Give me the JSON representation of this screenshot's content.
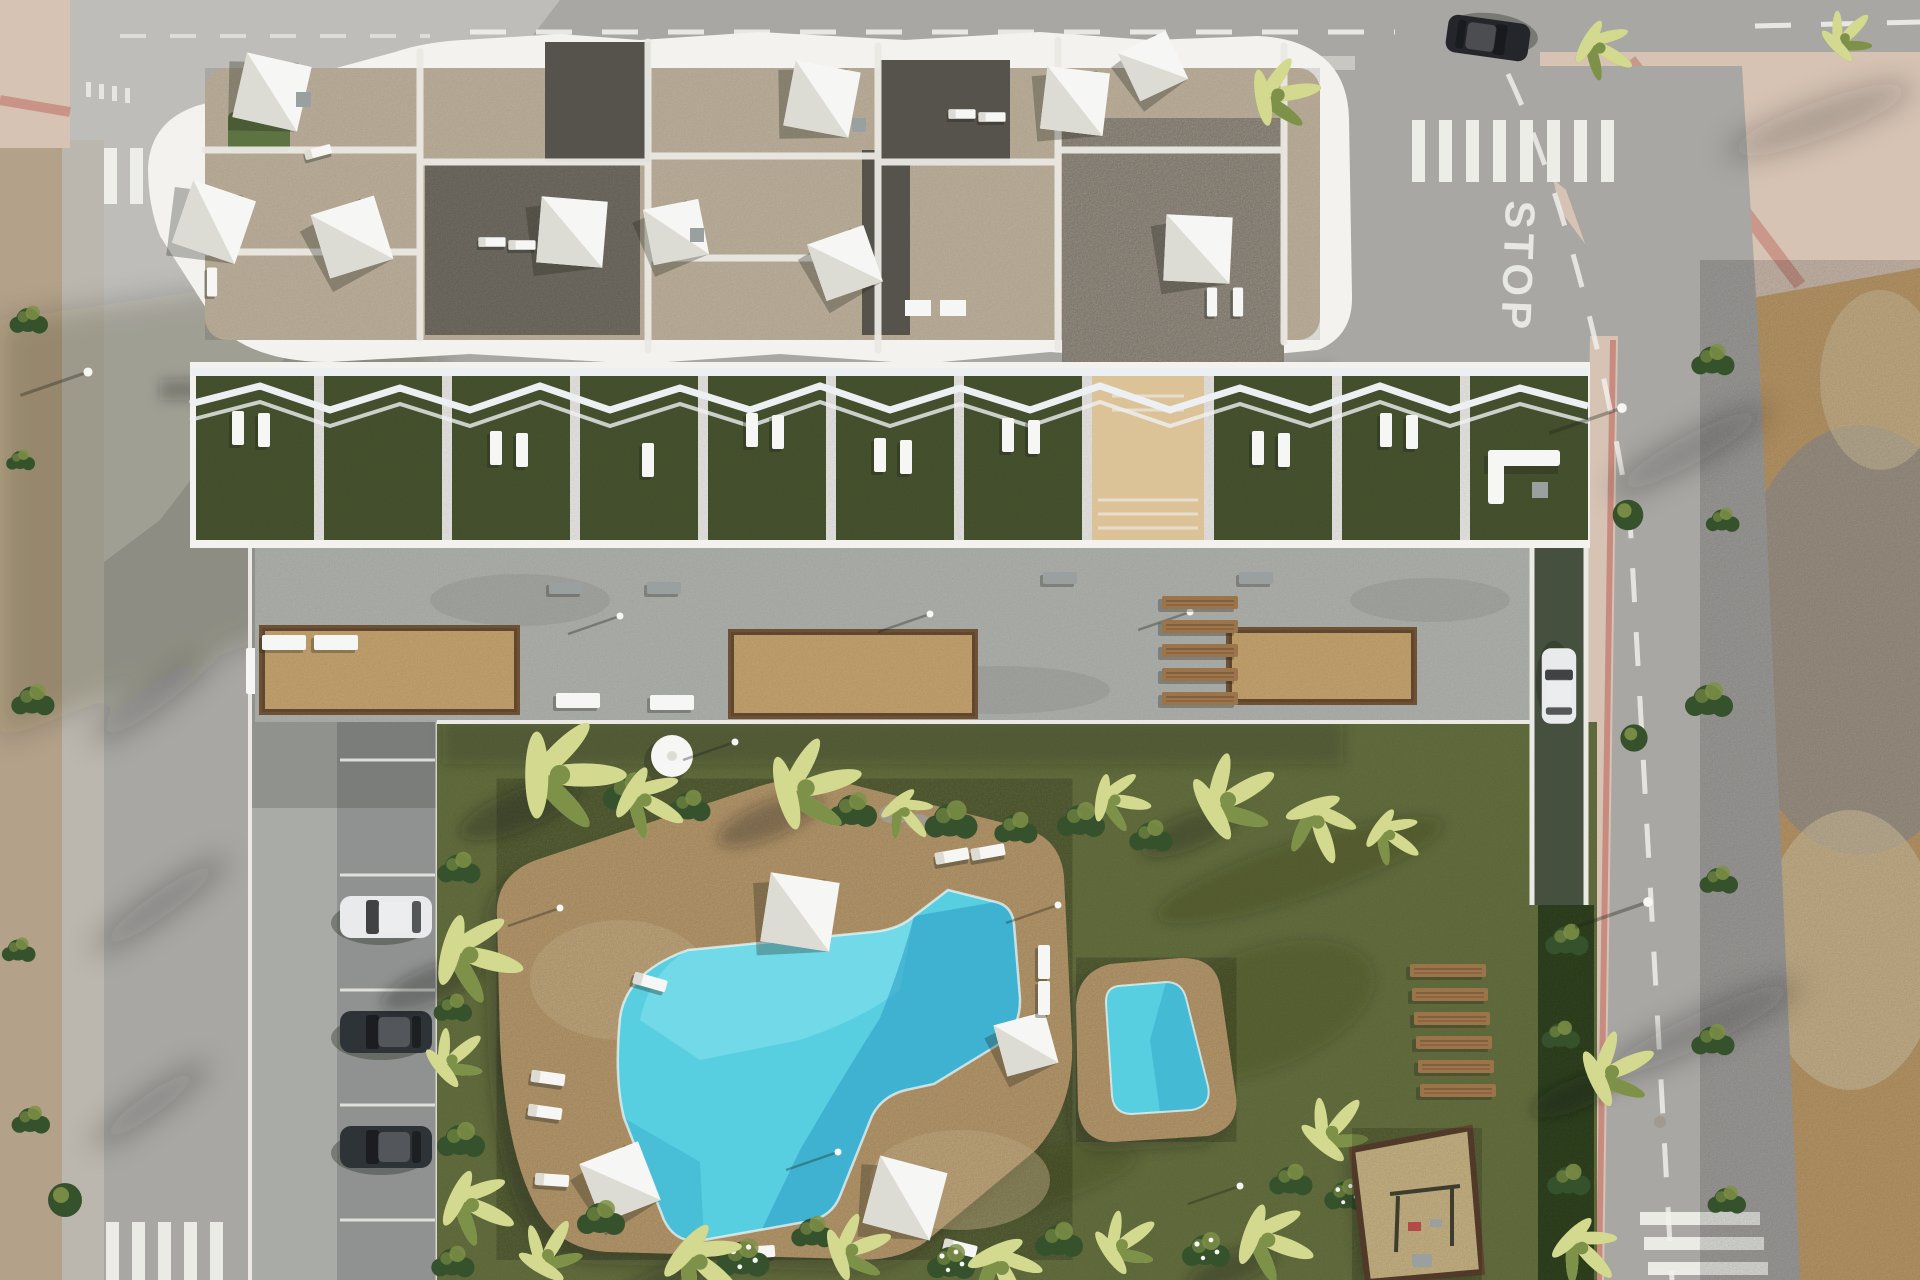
{
  "meta": {
    "description": "Top-down aerial 3D architectural render of a modern white apartment complex with rooftop terraces and shade sails, a row of private grass garden terraces, a communal concrete plaza with sand planters, a large lawned garden with palm trees, a free-form turquoise swimming pool with sun deck, a separate kids pool, wooden sun decks, a playground with swings, street parking and surrounding roads with an empty dirt lot",
    "view": "aerial top-down"
  },
  "roads": {
    "stop_marking": "STOP"
  },
  "colors": {
    "road": "#a8a7a4",
    "roadLight": "#d6d4cf",
    "laneWhite": "#f3f3ee",
    "sidewalkLeft": "#bcb7ae",
    "dirtLeft": "#b3a189",
    "dirtLight": "#d9c7a2",
    "concreteWalk": "#a9aba7",
    "parkingAsphalt": "#8f9290",
    "kerb": "#ebe9e4",
    "plaza": "#b9bbb6",
    "planterSand": "#d4b077",
    "planterEdge": "#6e5134",
    "building": "#f3f2ef",
    "roofStone": "#c9bca6",
    "gravelLight": "#b3a99b",
    "gravelDark": "#857f74",
    "roofDark": "#56534d",
    "roofGreen": "#5d7342",
    "pergola": "#edf0f2",
    "terraceGrass": "#4c5832",
    "lawn": "#6d7944",
    "shrub": "#35522c",
    "palmL": "#d3d98f",
    "palmD": "#7e9148",
    "deck": "#c9a877",
    "deckLight": "#dcc397",
    "water": "#58cfe0",
    "waterDeep": "#2f9fc6",
    "waterLight": "#8ae4ee",
    "wood": "#9b744a",
    "woodDark": "#6b4a2f",
    "sand": "#d8c28f",
    "hedge": "#3a5226",
    "rampGreen": "#46503f",
    "sidewalkRight": "#d6c3b4",
    "sidewalkRed": "#c2766a",
    "dirtRight": "#c6a26f",
    "gravelPatch": "#a29a8f",
    "carWhite": "#e8eaec",
    "carDark": "#2e3337",
    "carBlack": "#24262b",
    "benchGray": "#9aa0a0",
    "white": "#f6f6f4",
    "sailShade": "#dddcd4",
    "shadowInk": "#20241a",
    "swingRed": "#b24a4a"
  },
  "scene": {
    "building": {
      "rooftop_shade_sails": 10,
      "rooftop_gravel_roofs": 3,
      "garden_terraces": 9,
      "corner_terrace_with_sofa": 1
    },
    "plaza": {
      "sand_planters": 3,
      "benches": 8,
      "wooden_steps": 5
    },
    "pools": {
      "main_pool": 1,
      "kids_pool": 1,
      "pool_shade_sails": 4,
      "parasols": 1,
      "sun_loungers": 12
    },
    "garden": {
      "palm_trees": 22,
      "wooden_sun_decks": 6,
      "playground_swings": 2
    },
    "parking": {
      "cars_parked_left": 3,
      "car_on_ramp": 1,
      "car_on_street": 1,
      "parking_bays": 5
    }
  }
}
